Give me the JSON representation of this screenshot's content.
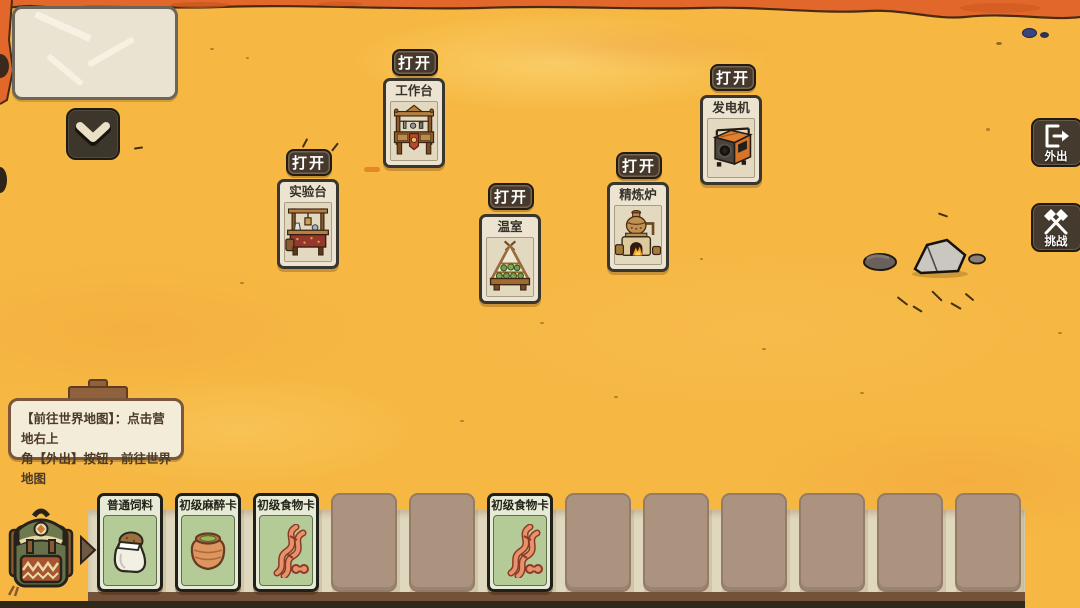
{
  "scene": {
    "name": "camp-view",
    "colors": {
      "sand": "#f6b843",
      "terrain_band": "#e2672a",
      "building_card_paper": "#ece4d0",
      "hand_card_green": "#b4cb97",
      "hand_bar": "#d2c5a7",
      "dark_button": "#46382b",
      "tooltip_paper": "#f3ecd8"
    }
  },
  "minimap_panel": {
    "icon": "paper-panel"
  },
  "collapse_button": {
    "icon": "chevron-down-icon"
  },
  "buildings": [
    {
      "id": "lab-bench",
      "label": "实验台",
      "open_label": "打开",
      "icon": "lab-bench-icon"
    },
    {
      "id": "workbench",
      "label": "工作台",
      "open_label": "打开",
      "icon": "workbench-icon"
    },
    {
      "id": "greenhouse",
      "label": "温室",
      "open_label": "打开",
      "icon": "greenhouse-icon"
    },
    {
      "id": "refining-furnace",
      "label": "精炼炉",
      "open_label": "打开",
      "icon": "furnace-icon"
    },
    {
      "id": "generator",
      "label": "发电机",
      "open_label": "打开",
      "icon": "generator-icon"
    }
  ],
  "side_buttons": [
    {
      "id": "go-out",
      "label": "外出",
      "icon": "exit-door-icon"
    },
    {
      "id": "challenge",
      "label": "挑战",
      "icon": "crossed-axes-icon"
    }
  ],
  "tooltip": {
    "line1": "【前往世界地图】：点击营地右上",
    "line2": "角【外出】按钮，前往世界地图"
  },
  "hand": {
    "slot_count": 12,
    "cards": [
      {
        "slot": 1,
        "label": "普通饲料",
        "icon": "feed-sack-icon"
      },
      {
        "slot": 2,
        "label": "初级麻醉卡",
        "icon": "clay-pot-icon"
      },
      {
        "slot": 3,
        "label": "初级食物卡",
        "icon": "dna-icon"
      },
      {
        "slot": 6,
        "label": "初级食物卡",
        "icon": "dna-icon"
      }
    ],
    "backpack_icon": "backpack-icon",
    "arrow_icon": "arrow-right-icon"
  }
}
